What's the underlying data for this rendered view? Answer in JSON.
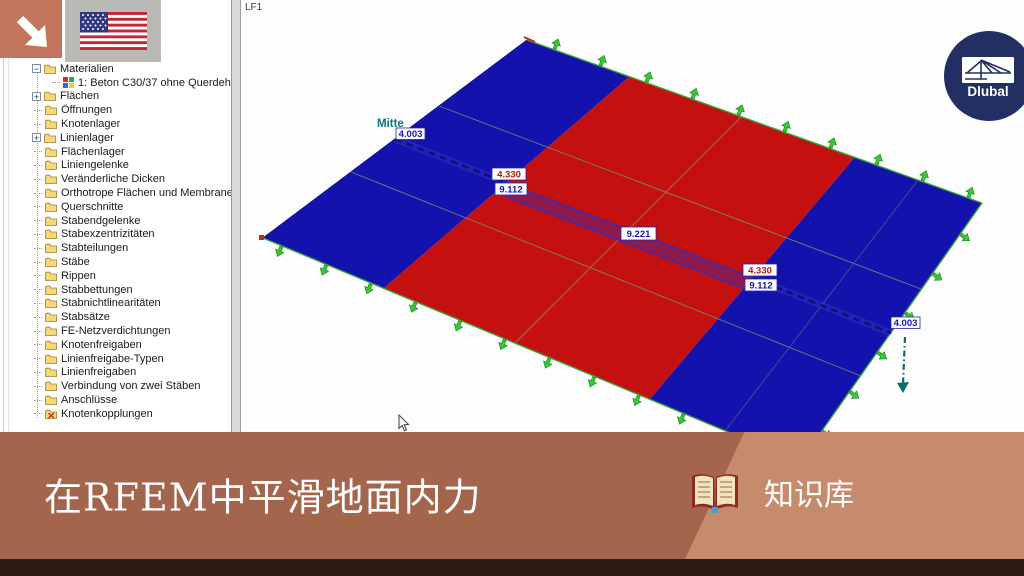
{
  "viewport": {
    "load_case_label": "LF1",
    "section_name": "Mitte"
  },
  "scene": {
    "colors": {
      "plate_blue": "#1412ad",
      "plate_red": "#c51010",
      "band_maroon": "#8e1b4f",
      "band_border_blue": "#2d2dc0",
      "section_navy": "#10106e",
      "section_glow": "#4646e0",
      "support_green": "#35c935",
      "support_green_dark": "#1f7a1f",
      "mesh_line": "#6b9b7b",
      "teal_arrow": "#0c6b6b",
      "label_navy": "#1515b0",
      "label_red": "#b01515",
      "mitte_teal": "#0a7a7a"
    },
    "labels": {
      "left_end": "4.003",
      "left_jump_top": "4.330",
      "left_jump_bottom": "9.112",
      "center": "9.221",
      "right_jump_top": "4.330",
      "right_jump_bottom": "9.112",
      "right_end": "4.003"
    }
  },
  "tree": {
    "items": [
      {
        "label": "Materialien",
        "depth": 1,
        "expand": "minus"
      },
      {
        "label": "1: Beton C30/37 ohne Querdehnung",
        "depth": 2,
        "icon": "material"
      },
      {
        "label": "Flächen",
        "depth": 1,
        "expand": "plus"
      },
      {
        "label": "Öffnungen",
        "depth": 1
      },
      {
        "label": "Knotenlager",
        "depth": 1
      },
      {
        "label": "Linienlager",
        "depth": 1,
        "expand": "plus"
      },
      {
        "label": "Flächenlager",
        "depth": 1
      },
      {
        "label": "Liniengelenke",
        "depth": 1
      },
      {
        "label": "Veränderliche Dicken",
        "depth": 1
      },
      {
        "label": "Orthotrope Flächen und Membranen",
        "depth": 1
      },
      {
        "label": "Querschnitte",
        "depth": 1
      },
      {
        "label": "Stabendgelenke",
        "depth": 1
      },
      {
        "label": "Stabexzentrizitäten",
        "depth": 1
      },
      {
        "label": "Stabteilungen",
        "depth": 1
      },
      {
        "label": "Stäbe",
        "depth": 1
      },
      {
        "label": "Rippen",
        "depth": 1
      },
      {
        "label": "Stabbettungen",
        "depth": 1
      },
      {
        "label": "Stabnichtlinearitäten",
        "depth": 1
      },
      {
        "label": "Stabsätze",
        "depth": 1
      },
      {
        "label": "FE-Netzverdichtungen",
        "depth": 1
      },
      {
        "label": "Knotenfreigaben",
        "depth": 1
      },
      {
        "label": "Linienfreigabe-Typen",
        "depth": 1
      },
      {
        "label": "Linienfreigaben",
        "depth": 1
      },
      {
        "label": "Verbindung von zwei Stäben",
        "depth": 1
      },
      {
        "label": "Anschlüsse",
        "depth": 1
      },
      {
        "label": "Knotenkopplungen",
        "depth": 1,
        "icon": "xfolder"
      }
    ]
  },
  "logo": {
    "text": "Dlubal"
  },
  "banner": {
    "title": "在RFEM中平滑地面内力",
    "badge_label": "知识库"
  }
}
